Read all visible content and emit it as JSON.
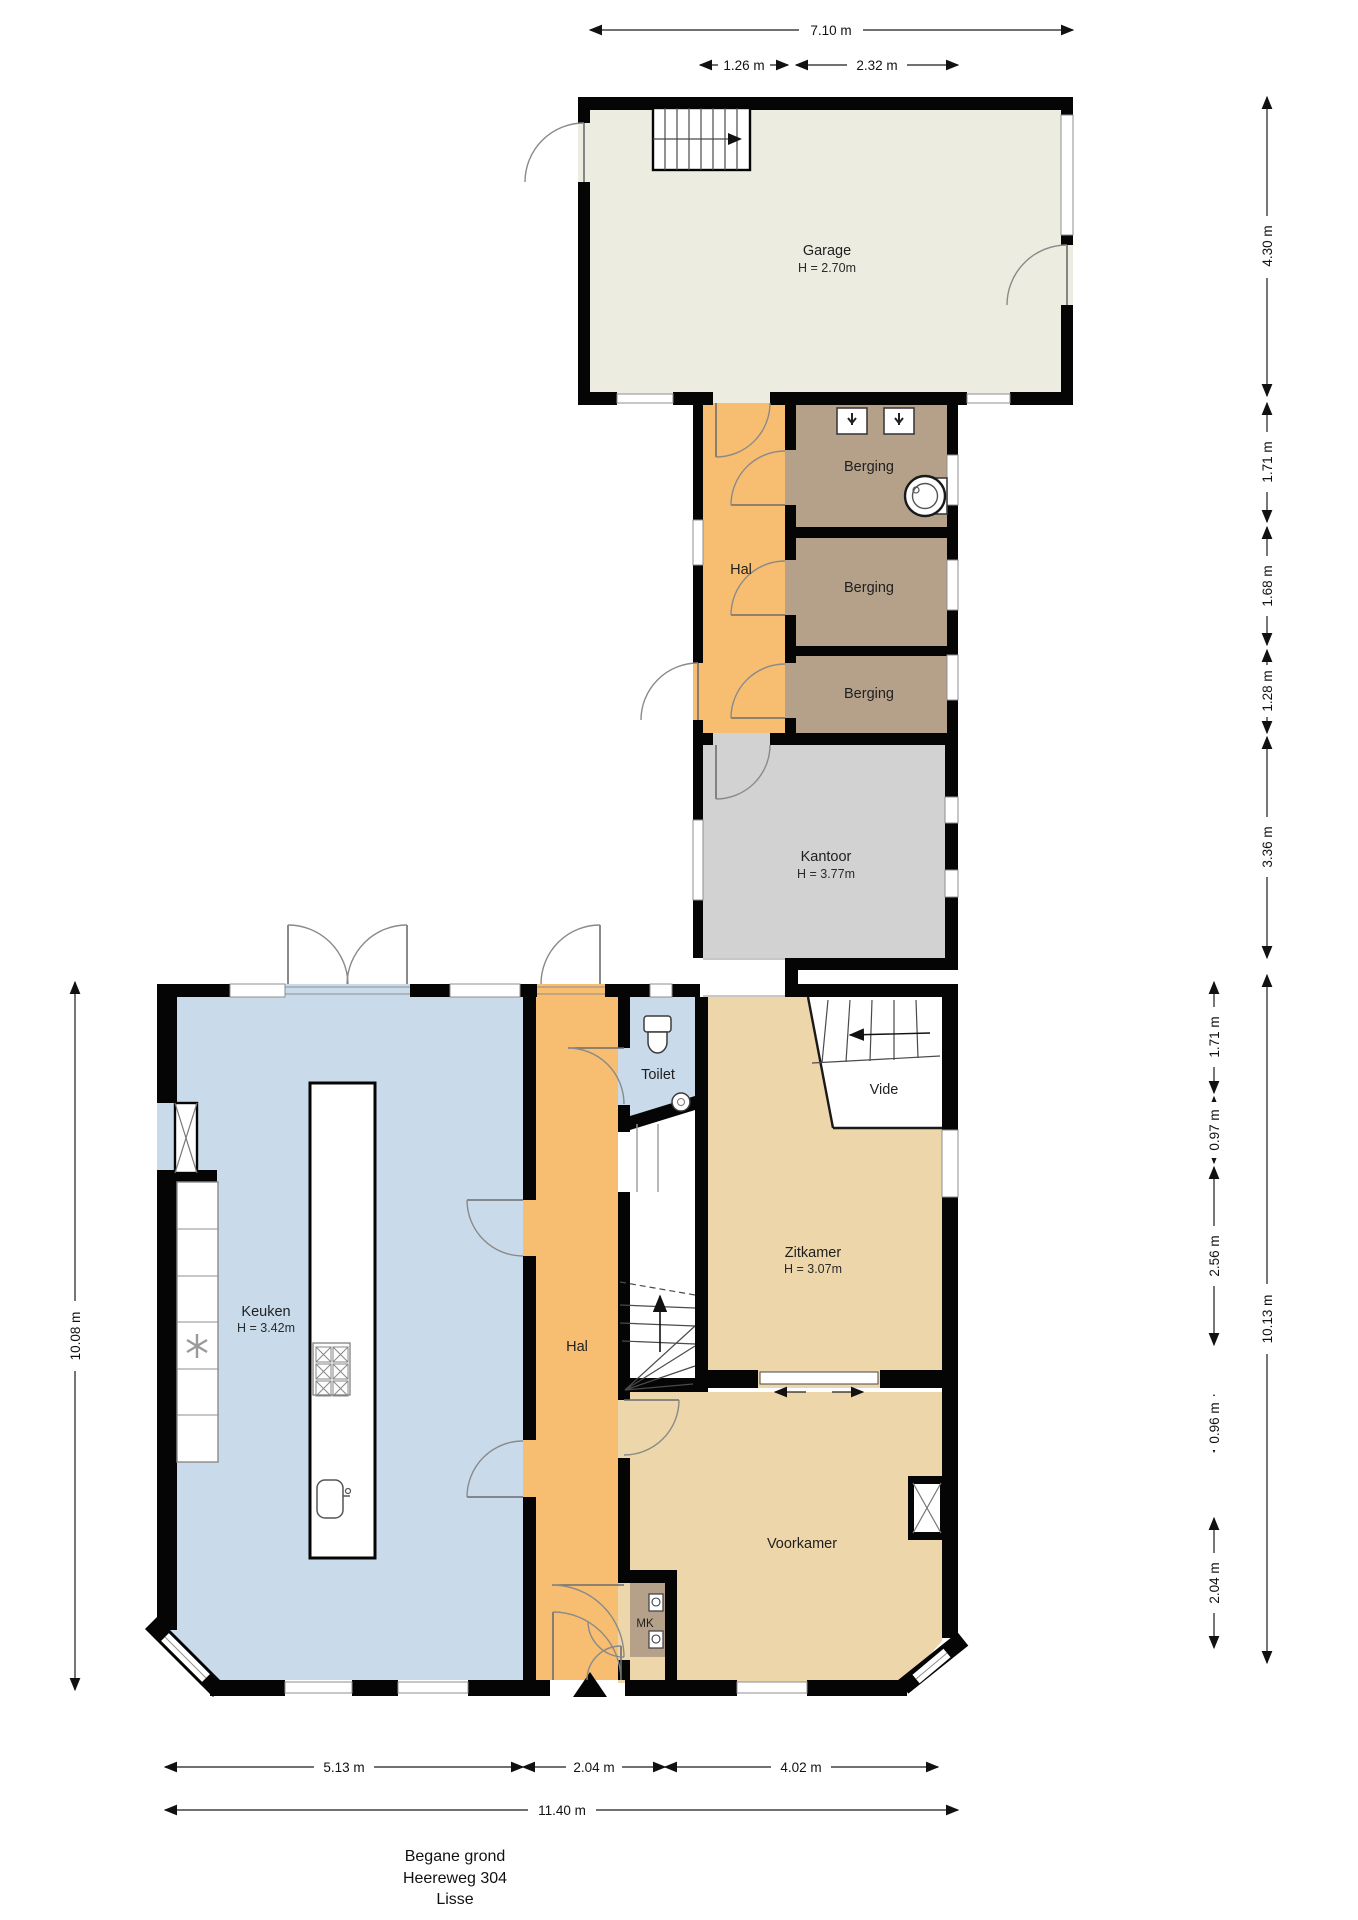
{
  "rooms": {
    "garage": {
      "name": "Garage",
      "height": "H = 2.70m"
    },
    "hal_boven": {
      "name": "Hal"
    },
    "berging1": {
      "name": "Berging"
    },
    "berging2": {
      "name": "Berging"
    },
    "berging3": {
      "name": "Berging"
    },
    "kantoor": {
      "name": "Kantoor",
      "height": "H = 3.77m"
    },
    "keuken": {
      "name": "Keuken",
      "height": "H = 3.42m"
    },
    "hal": {
      "name": "Hal"
    },
    "toilet": {
      "name": "Toilet"
    },
    "vide": {
      "name": "Vide"
    },
    "zitkamer": {
      "name": "Zitkamer",
      "height": "H = 3.07m"
    },
    "voorkamer": {
      "name": "Voorkamer"
    },
    "meterkast": {
      "name": "MK"
    }
  },
  "dims": {
    "top": [
      "7.10 m",
      "1.26 m",
      "2.32 m"
    ],
    "right_outer": [
      "4.30 m",
      "1.71 m",
      "1.68 m",
      "1.28 m",
      "3.36 m",
      "10.13 m"
    ],
    "right_inner": [
      "1.71 m",
      "0.97 m",
      "2.56 m",
      "0.96 m",
      "2.04 m"
    ],
    "left": [
      "10.08 m"
    ],
    "bottom": [
      "5.13 m",
      "2.04 m",
      "4.02 m",
      "11.40 m"
    ]
  },
  "title": {
    "floor": "Begane grond",
    "address": "Heereweg 304",
    "city": "Lisse"
  },
  "palette": {
    "wall": "#050505",
    "garage": "#ECECE1",
    "hal": "#F7BE71",
    "berging": "#B5A189",
    "kantoor": "#D2D2D2",
    "keuken": "#C9DBEA",
    "toilet": "#C9DBEA",
    "living": "#EDD6A9",
    "window": "#FFFFFF",
    "dim_text": "#111111"
  }
}
